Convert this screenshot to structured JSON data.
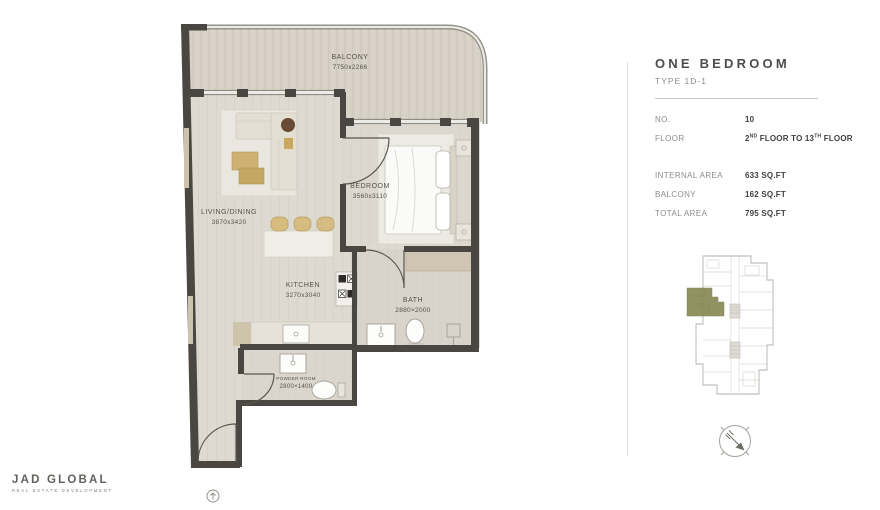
{
  "panel": {
    "title": "ONE BEDROOM",
    "subtitle": "TYPE 1D-1",
    "no_label": "NO.",
    "no_value": "10",
    "floor_label": "FLOOR",
    "floor_parts": {
      "p1": "2",
      "s1": "ND",
      "p2": " FLOOR TO 13",
      "s2": "TH",
      "p3": " FLOOR"
    },
    "internal_label": "INTERNAL AREA",
    "internal_value": "633 SQ.FT",
    "balcony_label": "BALCONY",
    "balcony_value": "162 SQ.FT",
    "total_label": "TOTAL AREA",
    "total_value": "795 SQ.FT"
  },
  "plan": {
    "rooms": [
      {
        "name": "BALCONY",
        "dims": "7750x2266"
      },
      {
        "name": "LIVING/DINING",
        "dims": "3870x3420"
      },
      {
        "name": "BEDROOM",
        "dims": "3560x3110"
      },
      {
        "name": "KITCHEN",
        "dims": "3270x3040"
      },
      {
        "name": "BATH",
        "dims": "2880×2000"
      },
      {
        "name": "POWDER ROOM",
        "dims": "2800×1400"
      }
    ]
  },
  "branding": {
    "logo": "JAD GLOBAL",
    "tagline": "REAL ESTATE DEVELOPMENT"
  },
  "colors": {
    "wall": "#4a4641",
    "floor_interior": "#dedad2",
    "floor_balcony": "#d7d0c4",
    "unit_highlight": "#8c8c59",
    "accent_tan": "#cdb173"
  }
}
